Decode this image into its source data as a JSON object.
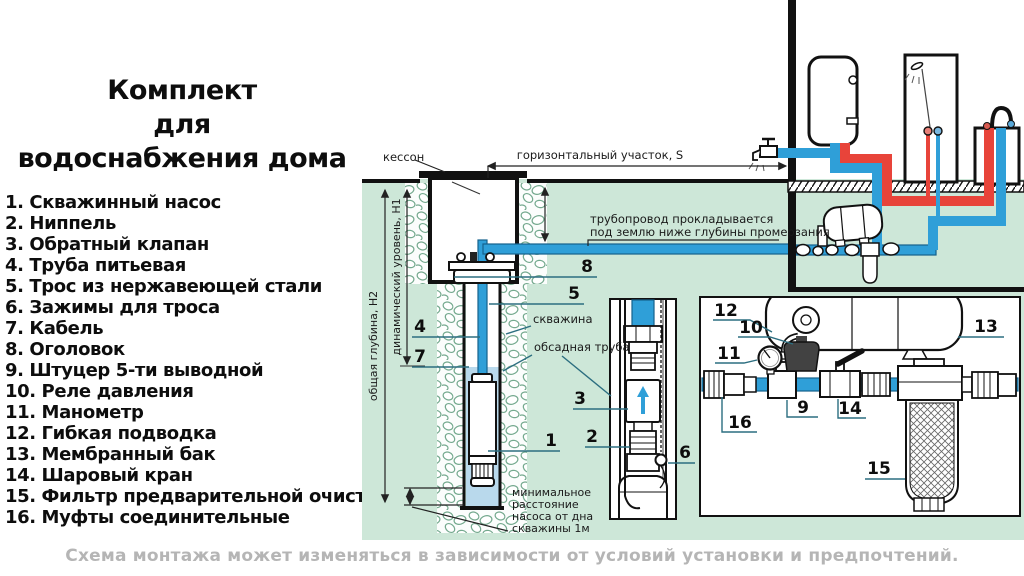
{
  "header": {
    "title_lines": [
      "Комплект",
      "для",
      "водоснабжения дома"
    ]
  },
  "legend": {
    "items": [
      "1. Скважинный насос",
      "2. Ниппель",
      "3. Обратный клапан",
      "4. Труба питьевая",
      "5. Трос из нержавеющей стали",
      "6. Зажимы для троса",
      "7. Кабель",
      "8. Оголовок",
      "9. Штуцер 5-ти выводной",
      "10. Реле давления",
      "11. Манометр",
      "12. Гибкая подводка",
      "13. Мембранный бак",
      "14. Шаровый кран",
      "15. Фильтр предварительной очистки",
      "16. Муфты соединительные"
    ]
  },
  "footer": {
    "caption": "Схема монтажа может изменяться в зависимости от условий установки и предпочтений."
  },
  "diagram": {
    "labels": {
      "caisson": "кессон",
      "horizontal_section": "горизонтальный участок, S",
      "pipeline_note_1": "трубопровод прокладывается",
      "pipeline_note_2": "под землю ниже глубины промерзания",
      "well": "скважина",
      "casing_pipe": "обсадная труба",
      "total_depth": "общая глубина, Н2",
      "dynamic_level": "динамический уровень, Н1",
      "min_distance_1": "минимальное",
      "min_distance_2": "расстояние",
      "min_distance_3": "насоса от дна",
      "min_distance_4": "скважины 1м"
    },
    "callouts": {
      "n1": "1",
      "n2": "2",
      "n3": "3",
      "n4": "4",
      "n5": "5",
      "n6": "6",
      "n7": "7",
      "n8": "8",
      "n9": "9",
      "n10": "10",
      "n11": "11",
      "n12": "12",
      "n13": "13",
      "n14": "14",
      "n15": "15",
      "n16": "16"
    },
    "colors": {
      "ground_green": "#cde7d8",
      "cold_pipe_blue": "#2f9fd8",
      "hot_pipe_red": "#e8443a",
      "well_water_blue": "#b9d9ec",
      "leader_teal": "#2c6e80",
      "caption_gray": "#b5b5b5"
    }
  }
}
